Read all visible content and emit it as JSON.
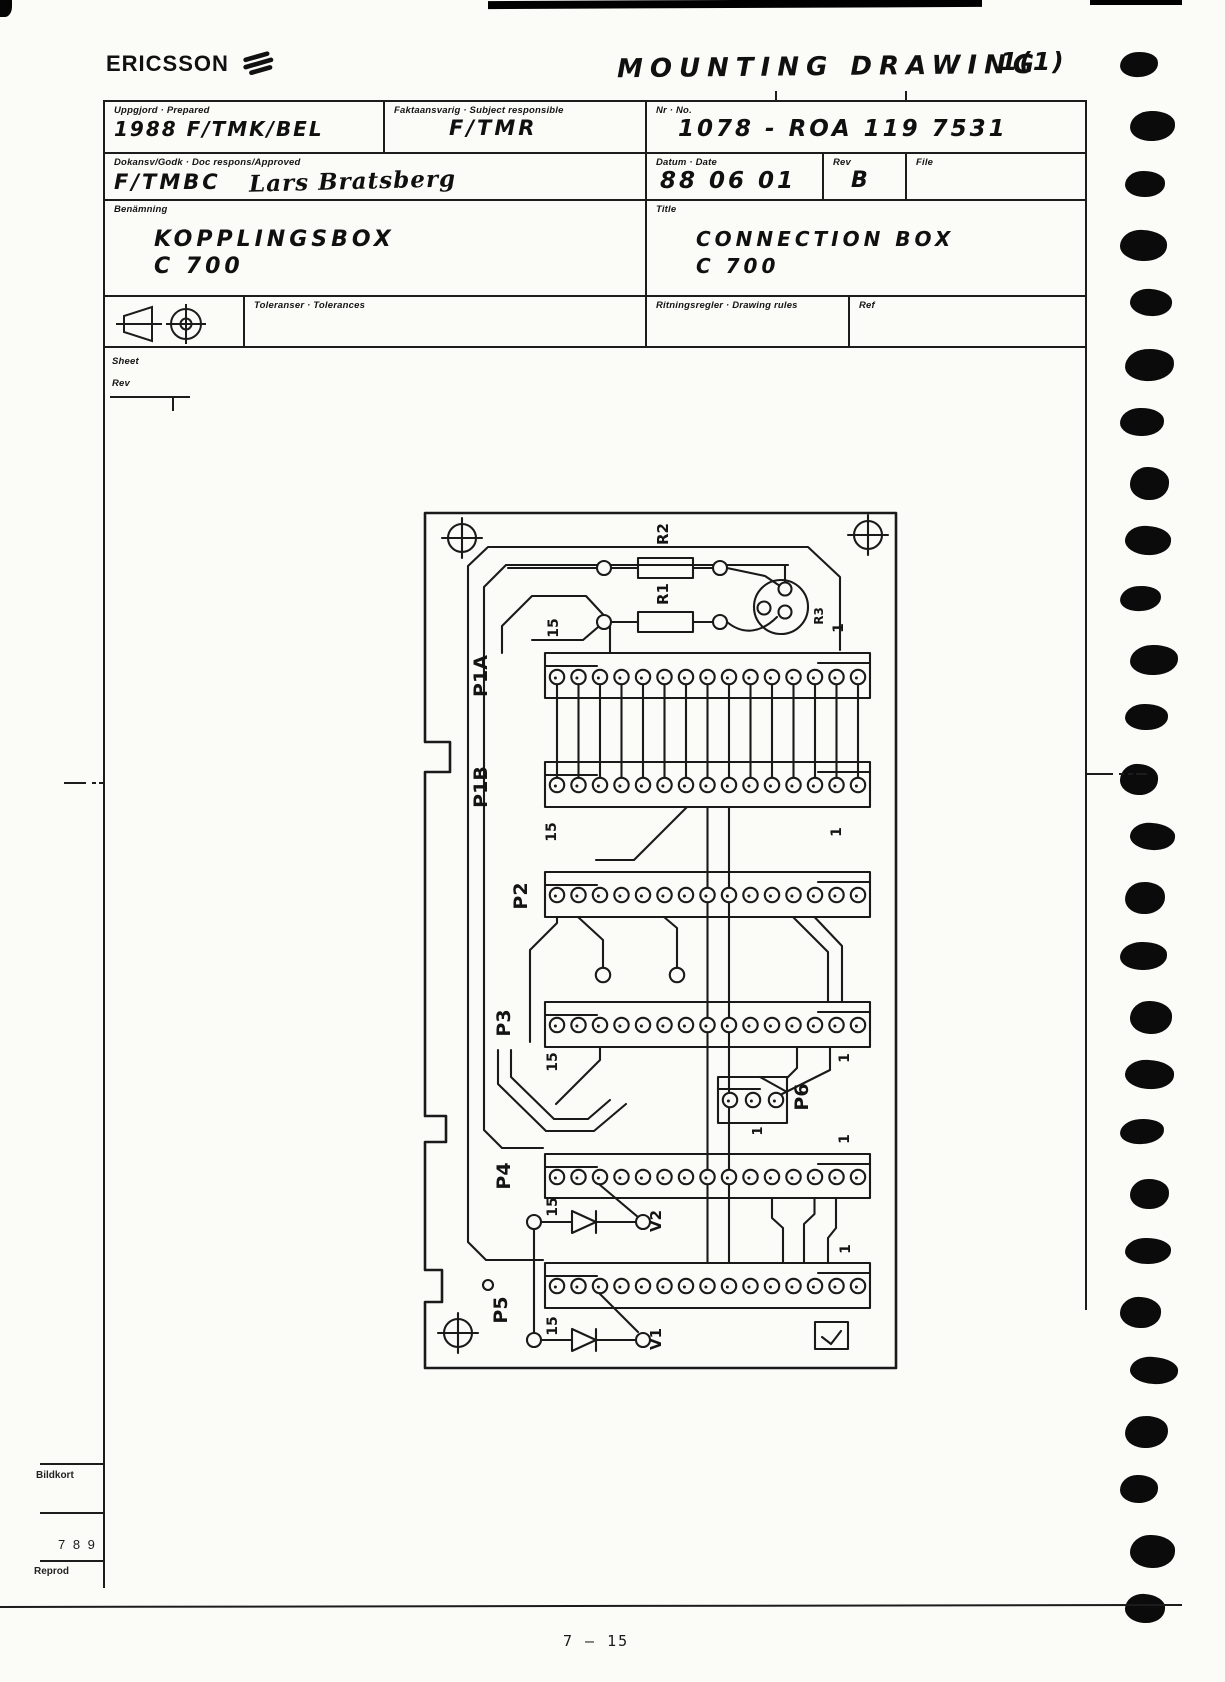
{
  "header": {
    "logo": "ERICSSON",
    "drawing_type": "MOUNTING DRAWING",
    "sheet_count": "1(1)"
  },
  "title_block": {
    "prepared_label": "Uppgjord · Prepared",
    "prepared_value": "1988  F/TMK/BEL",
    "subject_label": "Faktaansvarig · Subject responsible",
    "subject_value": "F/TMR",
    "no_label": "Nr · No.",
    "no_value": "1078 - ROA  119  7531",
    "approved_label": "Dokansv/Godk · Doc respons/Approved",
    "approved_org": "F/TMBC",
    "approved_name": "Lars Bratsberg",
    "date_label": "Datum · Date",
    "date_value": "88 06 01",
    "rev_label": "Rev",
    "rev_value": "B",
    "file_label": "File",
    "designation_label": "Benämning",
    "designation_line1": "KOPPLINGSBOX",
    "designation_line2": "C 700",
    "title_label": "Title",
    "title_line1": "CONNECTION  BOX",
    "title_line2": "C 700",
    "tolerances_label": "Toleranser · Tolerances",
    "rules_label": "Ritningsregler · Drawing rules",
    "ref_label": "Ref",
    "sheet_label": "Sheet",
    "rev_row_label": "Rev"
  },
  "board": {
    "labels": {
      "p1a": "P1A",
      "p1b": "P1B",
      "p2": "P2",
      "p3": "P3",
      "p4": "P4",
      "p5": "P5",
      "p6": "P6",
      "r1": "R1",
      "r2": "R2",
      "r3": "R3",
      "v1": "V1",
      "v2": "V2"
    },
    "pin_markers": {
      "start": "15",
      "end": "1"
    },
    "connectors": [
      {
        "id": "P1A",
        "pins": 15
      },
      {
        "id": "P1B",
        "pins": 15
      },
      {
        "id": "P2",
        "pins": 15
      },
      {
        "id": "P3",
        "pins": 15
      },
      {
        "id": "P4",
        "pins": 15
      },
      {
        "id": "P5",
        "pins": 15
      },
      {
        "id": "P6",
        "pins": 3
      }
    ]
  },
  "margin_notes": {
    "bildkort": "Bildkort",
    "number": "7 8 9",
    "reprod": "Reprod"
  },
  "footer": {
    "page": "7  –  15"
  }
}
